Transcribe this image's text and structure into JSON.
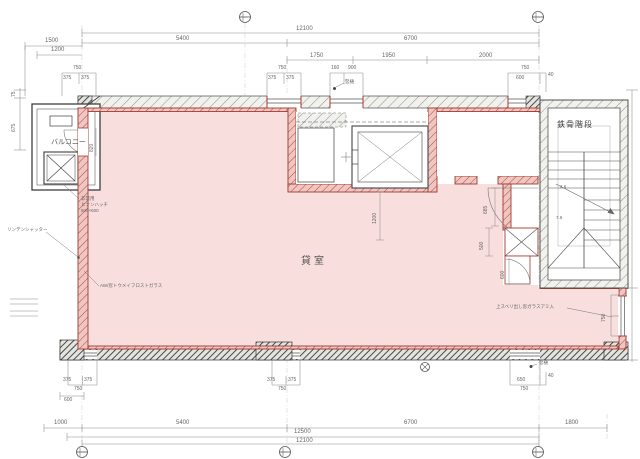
{
  "colors": {
    "room_fill": "#f8dedd",
    "wall_red": "#a5392f",
    "wall_pink": "#f0c6c3",
    "line_dark": "#3f3f3f",
    "dim_gray": "#6e6e6e",
    "background": "#ffffff"
  },
  "rooms": {
    "balcony": "バルコニー",
    "tenant_room": "貸室",
    "steel_staircase": "鉄骨階段"
  },
  "annotations": {
    "emergency_line1": "非常用",
    "emergency_line2": "ヒナンハッチ",
    "emergency_line3": "600×600",
    "shutter": "リンデンシャッター",
    "window_left": "AW/窓トウメイフロストガラス",
    "window_right": "上スベリ出し窓ガラスアミ入",
    "downspout_top": "竪樋",
    "downspout_bottom": "竪樋",
    "stair_note_upper": "2.6",
    "stair_note_lower": "7.6"
  },
  "dimensions": {
    "top": {
      "total": "12100",
      "span_left": "5400",
      "span_right": "6700",
      "offset_a": "1500",
      "offset_b": "1200",
      "sub_1": "1750",
      "sub_2": "1950",
      "sub_3": "2000",
      "win_a": {
        "w": "750",
        "half1": "375",
        "half2": "375"
      },
      "win_b": {
        "w": "750",
        "half1": "375",
        "half2": "375"
      },
      "win_c": {
        "p1": "160",
        "p2": "900"
      },
      "win_d": {
        "w": "750",
        "p1": "600",
        "p2": "40"
      }
    },
    "left": {
      "d1": "75",
      "d2": "675"
    },
    "right": {
      "win": "750"
    },
    "inner": {
      "elevator": "1200",
      "balcony_door": "820",
      "core_1": "685",
      "core_2": "500",
      "core_3": "600"
    },
    "bottom": {
      "offset": "1000",
      "span_left": "5400",
      "span_right": "6700",
      "offset_right": "1800",
      "total_1": "12500",
      "total_2": "12100",
      "win_e": {
        "half1": "375",
        "half2": "375",
        "w": "750",
        "sub": "600"
      },
      "win_f": {
        "half1": "375",
        "half2": "375",
        "w": "750"
      },
      "win_g": {
        "p1": "650",
        "p2": "40",
        "w": "750"
      }
    }
  }
}
